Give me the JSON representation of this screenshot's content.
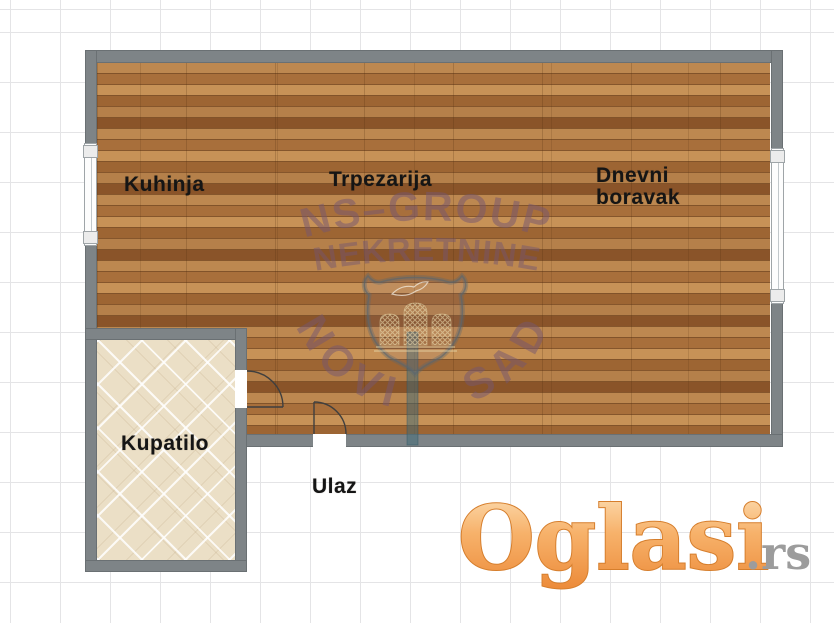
{
  "floorplan": {
    "rooms": [
      {
        "label": "Kuhinja"
      },
      {
        "label": "Trpezarija"
      },
      {
        "label": "Dnevni boravak"
      },
      {
        "label": "Kupatilo"
      },
      {
        "label": "Ulaz"
      }
    ],
    "features": {
      "windows": 2,
      "doors": 2,
      "shield_emblem": "novi-sad-coat-of-arms"
    },
    "watermark": {
      "line1": "NS–GROUP",
      "line2": "NEKRETNINE",
      "line3": "NOVI SAD"
    },
    "colors": {
      "wall": "#7e8487",
      "wood_floor": "#b17b46",
      "bath_tile": "#ebdfc6",
      "watermark_text": "#765670",
      "partition": "#3e6978",
      "logo_orange": "#ef9a52",
      "logo_gray": "#9c9c9c",
      "grid": "#e4e4e6"
    }
  },
  "logo": {
    "name": "Oglasi",
    "tld": ".rs"
  }
}
